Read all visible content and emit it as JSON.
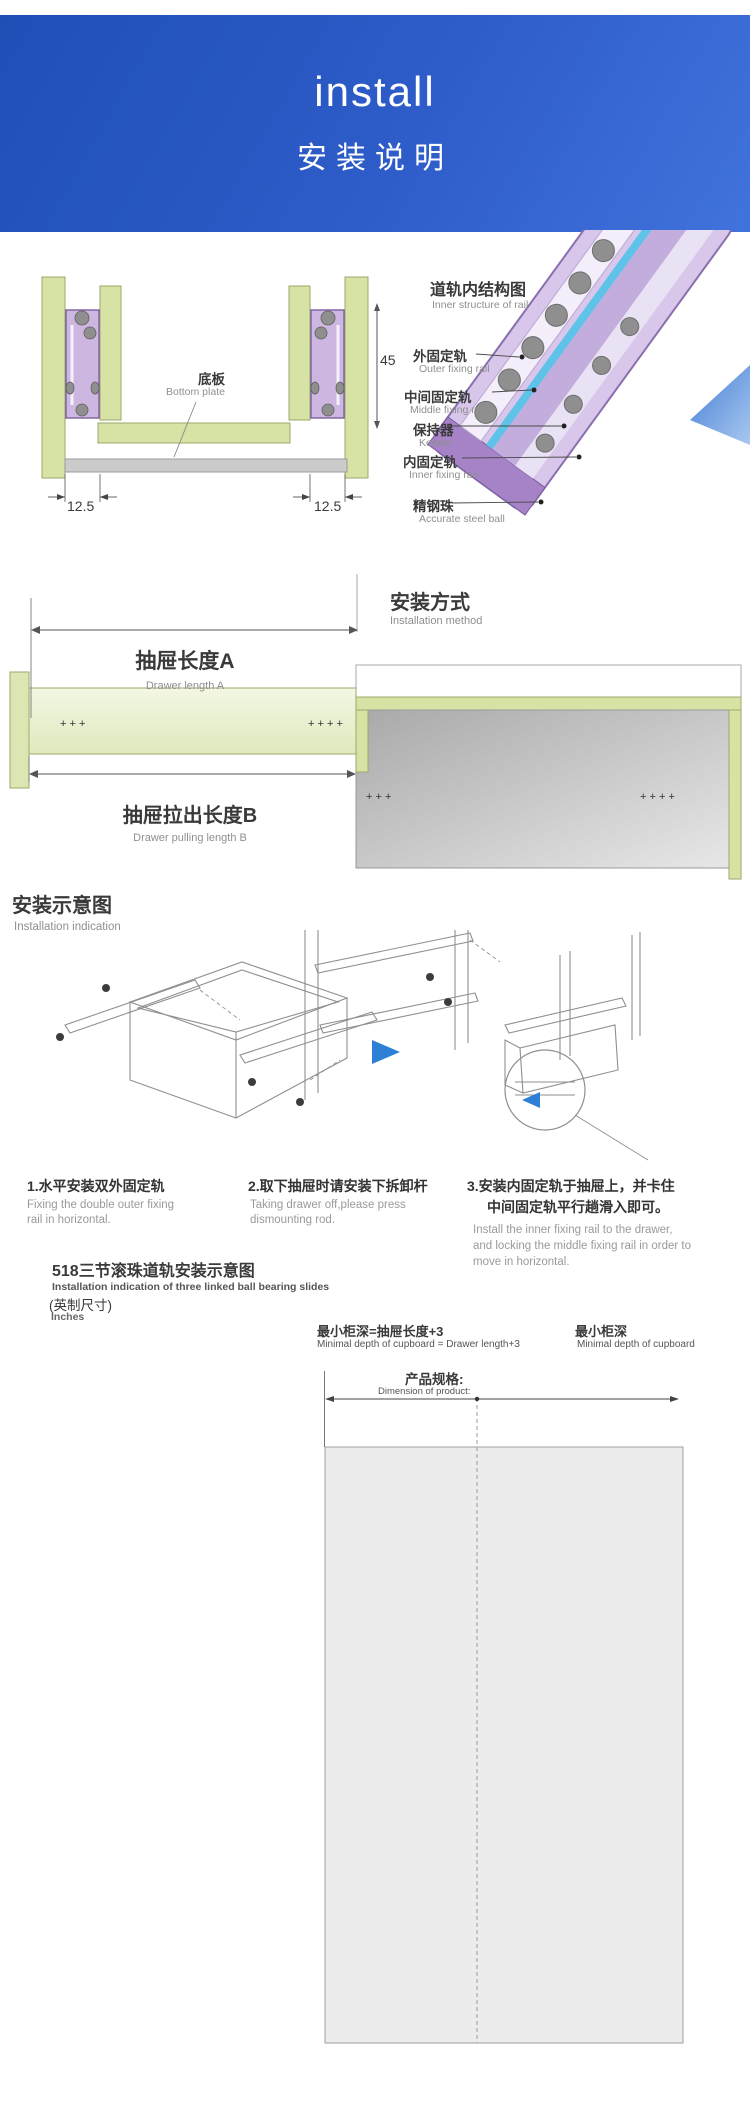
{
  "header": {
    "title_en": "install",
    "title_cn": "安装说明"
  },
  "section_rail": {
    "inner_title_cn": "道轨内结构图",
    "inner_title_en": "Inner structure of rail",
    "labels": [
      {
        "cn": "外固定轨",
        "en": "Outer fixing rail"
      },
      {
        "cn": "中间固定轨",
        "en": "Middle fixing rail"
      },
      {
        "cn": "保持器",
        "en": "Keeper"
      },
      {
        "cn": "内固定轨",
        "en": "Inner fixing rail"
      },
      {
        "cn": "精钢珠",
        "en": "Accurate steel ball"
      }
    ],
    "bottom_plate_cn": "底板",
    "bottom_plate_en": "Bottom plate",
    "dims": {
      "height": "45",
      "left": "12.5",
      "right": "12.5"
    }
  },
  "section_method": {
    "title_cn": "安装方式",
    "title_en": "Installation method",
    "length_a_cn": "抽屉长度A",
    "length_a_en": "Drawer length A",
    "length_b_cn": "抽屉拉出长度B",
    "length_b_en": "Drawer pulling length B"
  },
  "section_steps": {
    "title_cn": "安装示意图",
    "title_en": "Installation indication",
    "steps": [
      {
        "cn": "1.水平安装双外固定轨",
        "en_lines": [
          "Fixing the double outer fixing",
          "rail in horizontal."
        ]
      },
      {
        "cn": "2.取下抽屉时请安装下拆卸杆",
        "en_lines": [
          "Taking drawer off,please press",
          "dismounting rod."
        ]
      },
      {
        "cn_lines": [
          "3.安装内固定轨于抽屉上，并卡住",
          "中间固定轨平行趟滑入即可。"
        ],
        "en_lines": [
          "Install the inner fixing rail to the drawer,",
          "and locking the middle fixing rail in order to",
          "move in horizontal."
        ]
      }
    ]
  },
  "size_chart": {
    "title_cn": "518三节滚珠道轨安装示意图",
    "title_en": "Installation indication of three linked ball bearing slides",
    "unit_cn": "(英制尺寸)",
    "unit_en": "Inches",
    "formula_cn": "最小柜深=抽屉长度+3",
    "formula_en": "Minimal depth of cupboard = Drawer length+3",
    "min_depth_cn": "最小柜深",
    "min_depth_en": "Minimal depth of cupboard",
    "product_dim_cn": "产品规格:",
    "product_dim_en": "Dimension of product:",
    "columns": [
      "10\"",
      "12\"",
      "14\"",
      "16\"",
      "18\"",
      "20\"",
      "22\"",
      "24\""
    ],
    "drawer_length_en": "Drawer length",
    "rows": [
      {
        "label": "10 \" (254mm)",
        "ann_cn": "抽屉长度254",
        "length": "254"
      },
      {
        "label": "12 \" (305mm)",
        "ann_cn": "抽屉长度305",
        "length": "305"
      },
      {
        "label": "14 \" (355mm)",
        "ann_cn": "抽屉长度355",
        "length": "355"
      },
      {
        "label": "16 \" (405mm)",
        "ann_cn": "抽屉长度405",
        "length": "405"
      },
      {
        "label": "18 \" (357mm)",
        "ann_cn": "抽屉长度457",
        "length": "457"
      },
      {
        "label": "20 \" (508mm)",
        "ann_cn": "抽屉长度508",
        "length": "508"
      },
      {
        "label": "22 \" (558mm)",
        "ann_cn": "抽屉长度558",
        "length": "558"
      },
      {
        "label": "24 \" (610mm)",
        "ann_cn": "抽屉长度610",
        "length": "610"
      }
    ]
  }
}
